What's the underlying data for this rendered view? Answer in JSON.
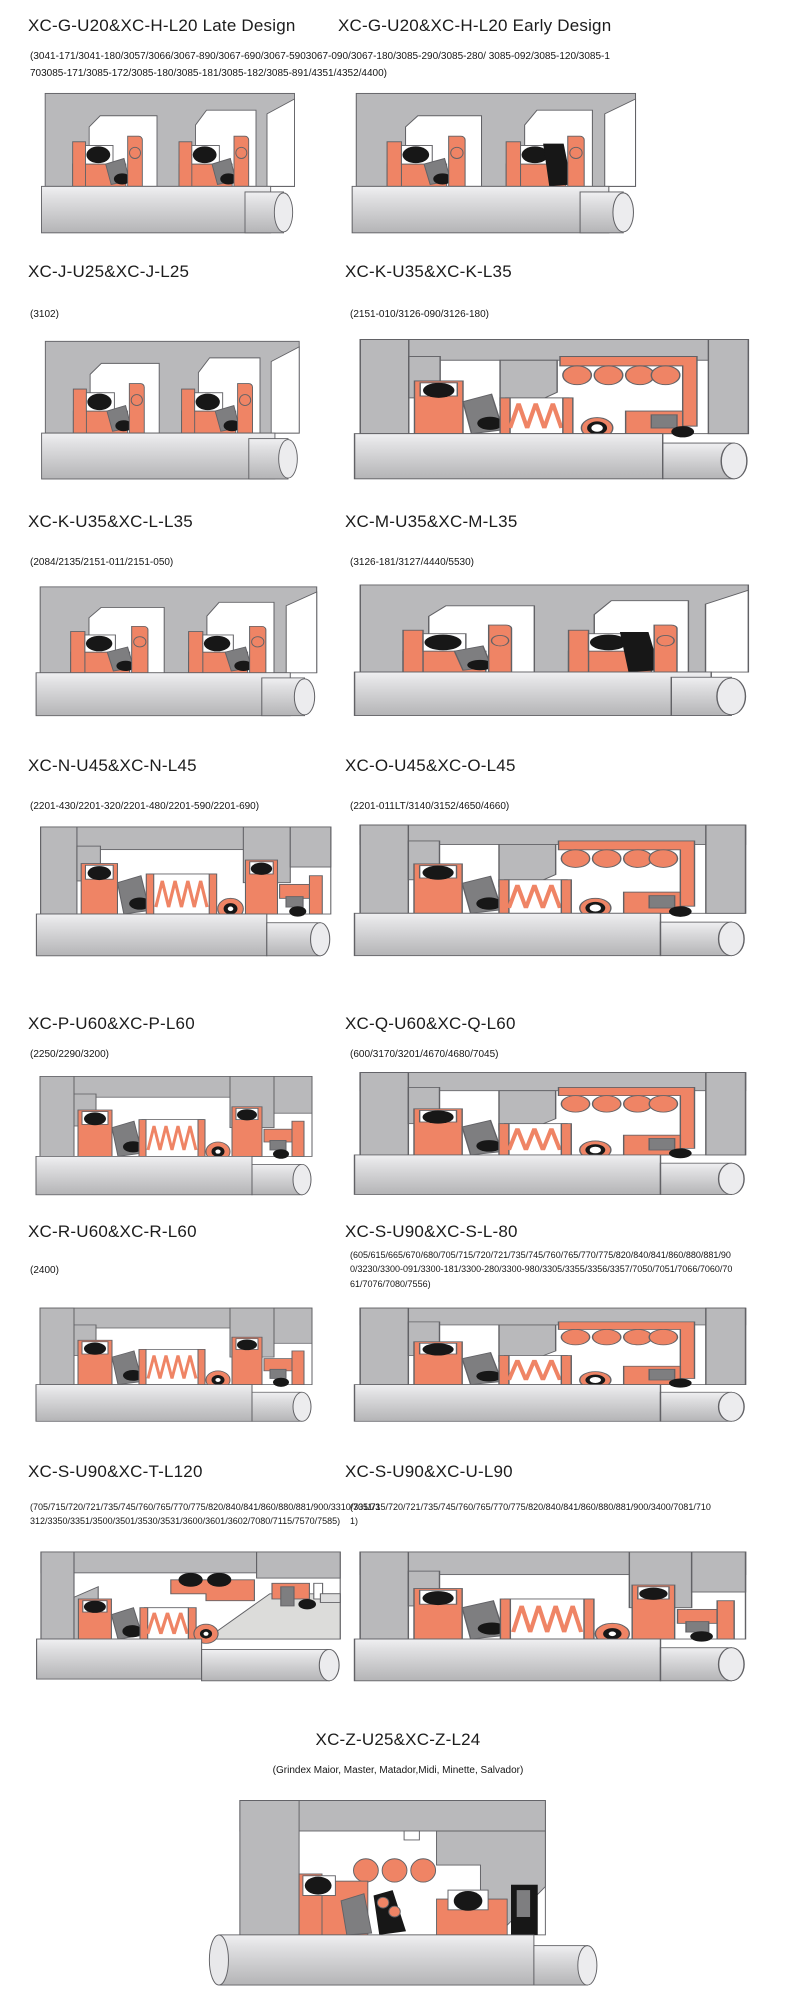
{
  "palette": {
    "housing": "#b9b9bb",
    "edge": "#626266",
    "salmon": "#ef8465",
    "dark": "#7e7e80",
    "black": "#171717",
    "cavity": "#ffffff",
    "shaft_light": "#f0f0f2",
    "shaft_dark": "#b4b4b6",
    "wedge_gray": "#dcdcda"
  },
  "sections": [
    {
      "title": "XC-G-U20&XC-H-L20 Late Design",
      "subtitle": "(3041-171/3041-180/3057/3066/3067-890/3067-690/3067-5903067-090/3067-180/3085-290/3085-280/ 3085-092/3085-120/3085-1703085-171/3085-172/3085-180/3085-181/3085-182/3085-891/4351/4352/4400)",
      "variant": "twin"
    },
    {
      "title": "XC-G-U20&XC-H-L20 Early Design",
      "subtitle": "",
      "variant": "twinb"
    },
    {
      "title": "XC-J-U25&XC-J-L25",
      "subtitle": "(3102)",
      "variant": "twin"
    },
    {
      "title": "XC-K-U35&XC-K-L35",
      "subtitle": "(2151-010/3126-090/3126-180)",
      "variant": "coil2"
    },
    {
      "title": "XC-K-U35&XC-L-L35",
      "subtitle": "(2084/2135/2151-011/2151-050)",
      "variant": "twin"
    },
    {
      "title": "XC-M-U35&XC-M-L35",
      "subtitle": "(3126-181/3127/4440/5530)",
      "variant": "twinb"
    },
    {
      "title": "XC-N-U45&XC-N-L45",
      "subtitle": "(2201-430/2201-320/2201-480/2201-590/2201-690)",
      "variant": "coil"
    },
    {
      "title": "XC-O-U45&XC-O-L45",
      "subtitle": "(2201-011LT/3140/3152/4650/4660)",
      "variant": "coil2"
    },
    {
      "title": "XC-P-U60&XC-P-L60",
      "subtitle": "(2250/2290/3200)",
      "variant": "coil"
    },
    {
      "title": "XC-Q-U60&XC-Q-L60",
      "subtitle": "(600/3170/3201/4670/4680/7045)",
      "variant": "coil2"
    },
    {
      "title": "XC-R-U60&XC-R-L60",
      "subtitle": "(2400)",
      "variant": "coil"
    },
    {
      "title": "XC-S-U90&XC-S-L-80",
      "subtitle": "(605/615/665/670/680/705/715/720/721/735/745/760/765/770/775/820/840/841/860/880/881/900/3230/3300-091/3300-181/3300-280/3300-980/3305/3355/3356/3357/7050/7051/7066/7060/7061/7076/7080/7556)",
      "variant": "coil2"
    },
    {
      "title": "XC-S-U90&XC-T-L120",
      "subtitle": "(705/715/720/721/735/745/760/765/770/775/820/840/841/860/880/881/900/3310/3311/3312/3350/3351/3500/3501/3530/3531/3600/3601/3602/7080/7115/7570/7585)",
      "variant": "wedge"
    },
    {
      "title": "XC-S-U90&XC-U-L90",
      "subtitle": "(705/715/720/721/735/745/760/765/770/775/820/840/841/860/880/881/900/3400/7081/7101)",
      "variant": "coil"
    },
    {
      "title": "XC-Z-U25&XC-Z-L24",
      "subtitle": "(Grindex  Maior, Master, Matador,Midi, Minette, Salvador)",
      "variant": "z"
    }
  ]
}
